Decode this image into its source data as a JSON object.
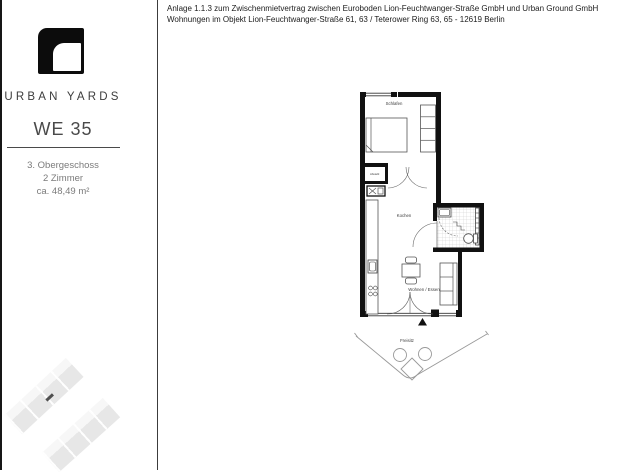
{
  "page": {
    "background": "#ffffff",
    "left_border_color": "#161616",
    "divider_color": "#3c3c3c"
  },
  "header": {
    "line1": "Anlage 1.1.3 zum Zwischenmietvertrag zwischen Euroboden Lion-Feuchtwanger-Straße GmbH und Urban Ground GmbH",
    "line2": "Wohnungen im Objekt Lion-Feuchtwanger-Straße 61, 63 / Teterower Ring 63, 65 - 12619 Berlin"
  },
  "sidebar": {
    "brand": "URBAN YARDS",
    "unit": "WE 35",
    "details": [
      "3. Obergeschoss",
      "2 Zimmer",
      "ca. 48,49 m²"
    ]
  },
  "floorplan": {
    "rooms": {
      "bedroom": "Schlafen",
      "storage": "Abstellr.",
      "kitchen": "Kochen",
      "living": "Wohnen / Essen",
      "terrace": "Freisitz"
    },
    "colors": {
      "wall": "#111111",
      "furniture_line": "#555555",
      "tile_line": "#c2c2c2"
    }
  }
}
